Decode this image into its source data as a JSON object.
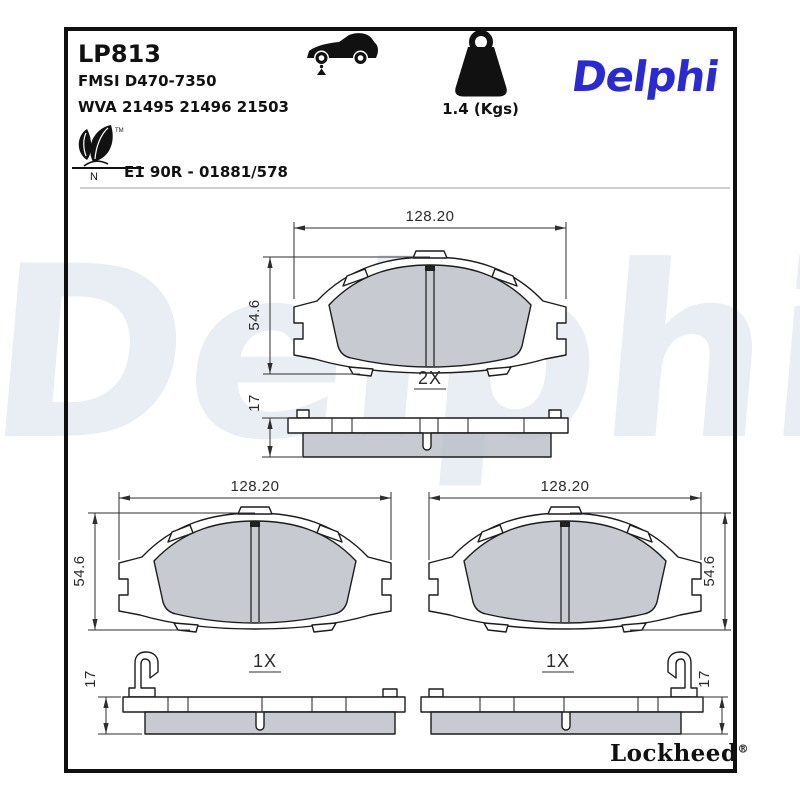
{
  "header": {
    "part_number": "LP813",
    "fmsi": "FMSI D470-7350",
    "wva": "WVA 21495 21496 21503",
    "ece_mark": "E1 90R - 01881/578",
    "weight_label": "1.4 (Kgs)",
    "brand": "Delphi",
    "leaf_trademark": "TM",
    "leaf_letter": "N"
  },
  "drawings": {
    "top_pad": {
      "width": "128.20",
      "height": "54.6",
      "thickness": "17",
      "quantity": "2X"
    },
    "bottom_left_pad": {
      "width": "128.20",
      "height": "54.6",
      "thickness": "17",
      "quantity": "1X"
    },
    "bottom_right_pad": {
      "width": "128.20",
      "height": "54.6",
      "thickness": "17",
      "quantity": "1X"
    }
  },
  "footer": {
    "brand": "Lockheed",
    "registered": "®"
  },
  "watermark": {
    "text": "Delphi"
  },
  "colors": {
    "brand_blue": "#2a2ad0",
    "watermark": "#e9edf4",
    "friction_gray": "#c9ccd1"
  }
}
